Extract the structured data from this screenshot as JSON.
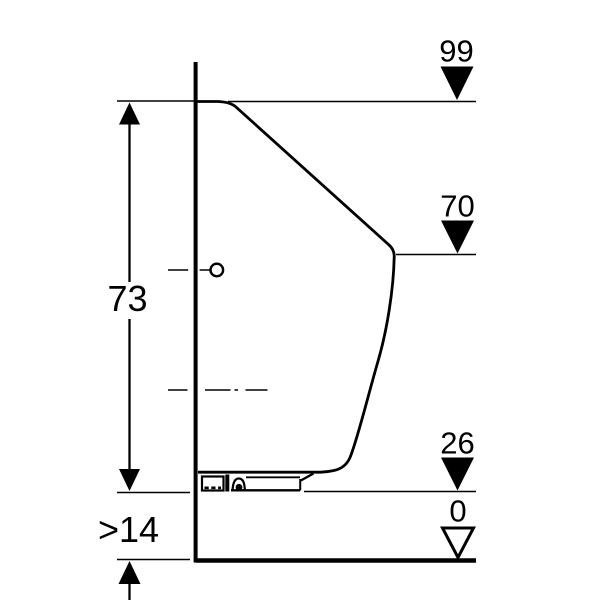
{
  "diagram": {
    "type": "technical-installation-side-view",
    "background_color": "#ffffff",
    "line_color": "#000000",
    "left_dimensions": {
      "overall_height": "73",
      "min_floor_clearance": ">14"
    },
    "level_markers": [
      {
        "id": "level-99",
        "label": "99",
        "marker": "filled-triangle-down"
      },
      {
        "id": "level-70",
        "label": "70",
        "marker": "filled-triangle-down"
      },
      {
        "id": "level-26",
        "label": "26",
        "marker": "filled-triangle-down"
      },
      {
        "id": "level-0",
        "label": "0",
        "marker": "open-triangle-down"
      }
    ]
  }
}
